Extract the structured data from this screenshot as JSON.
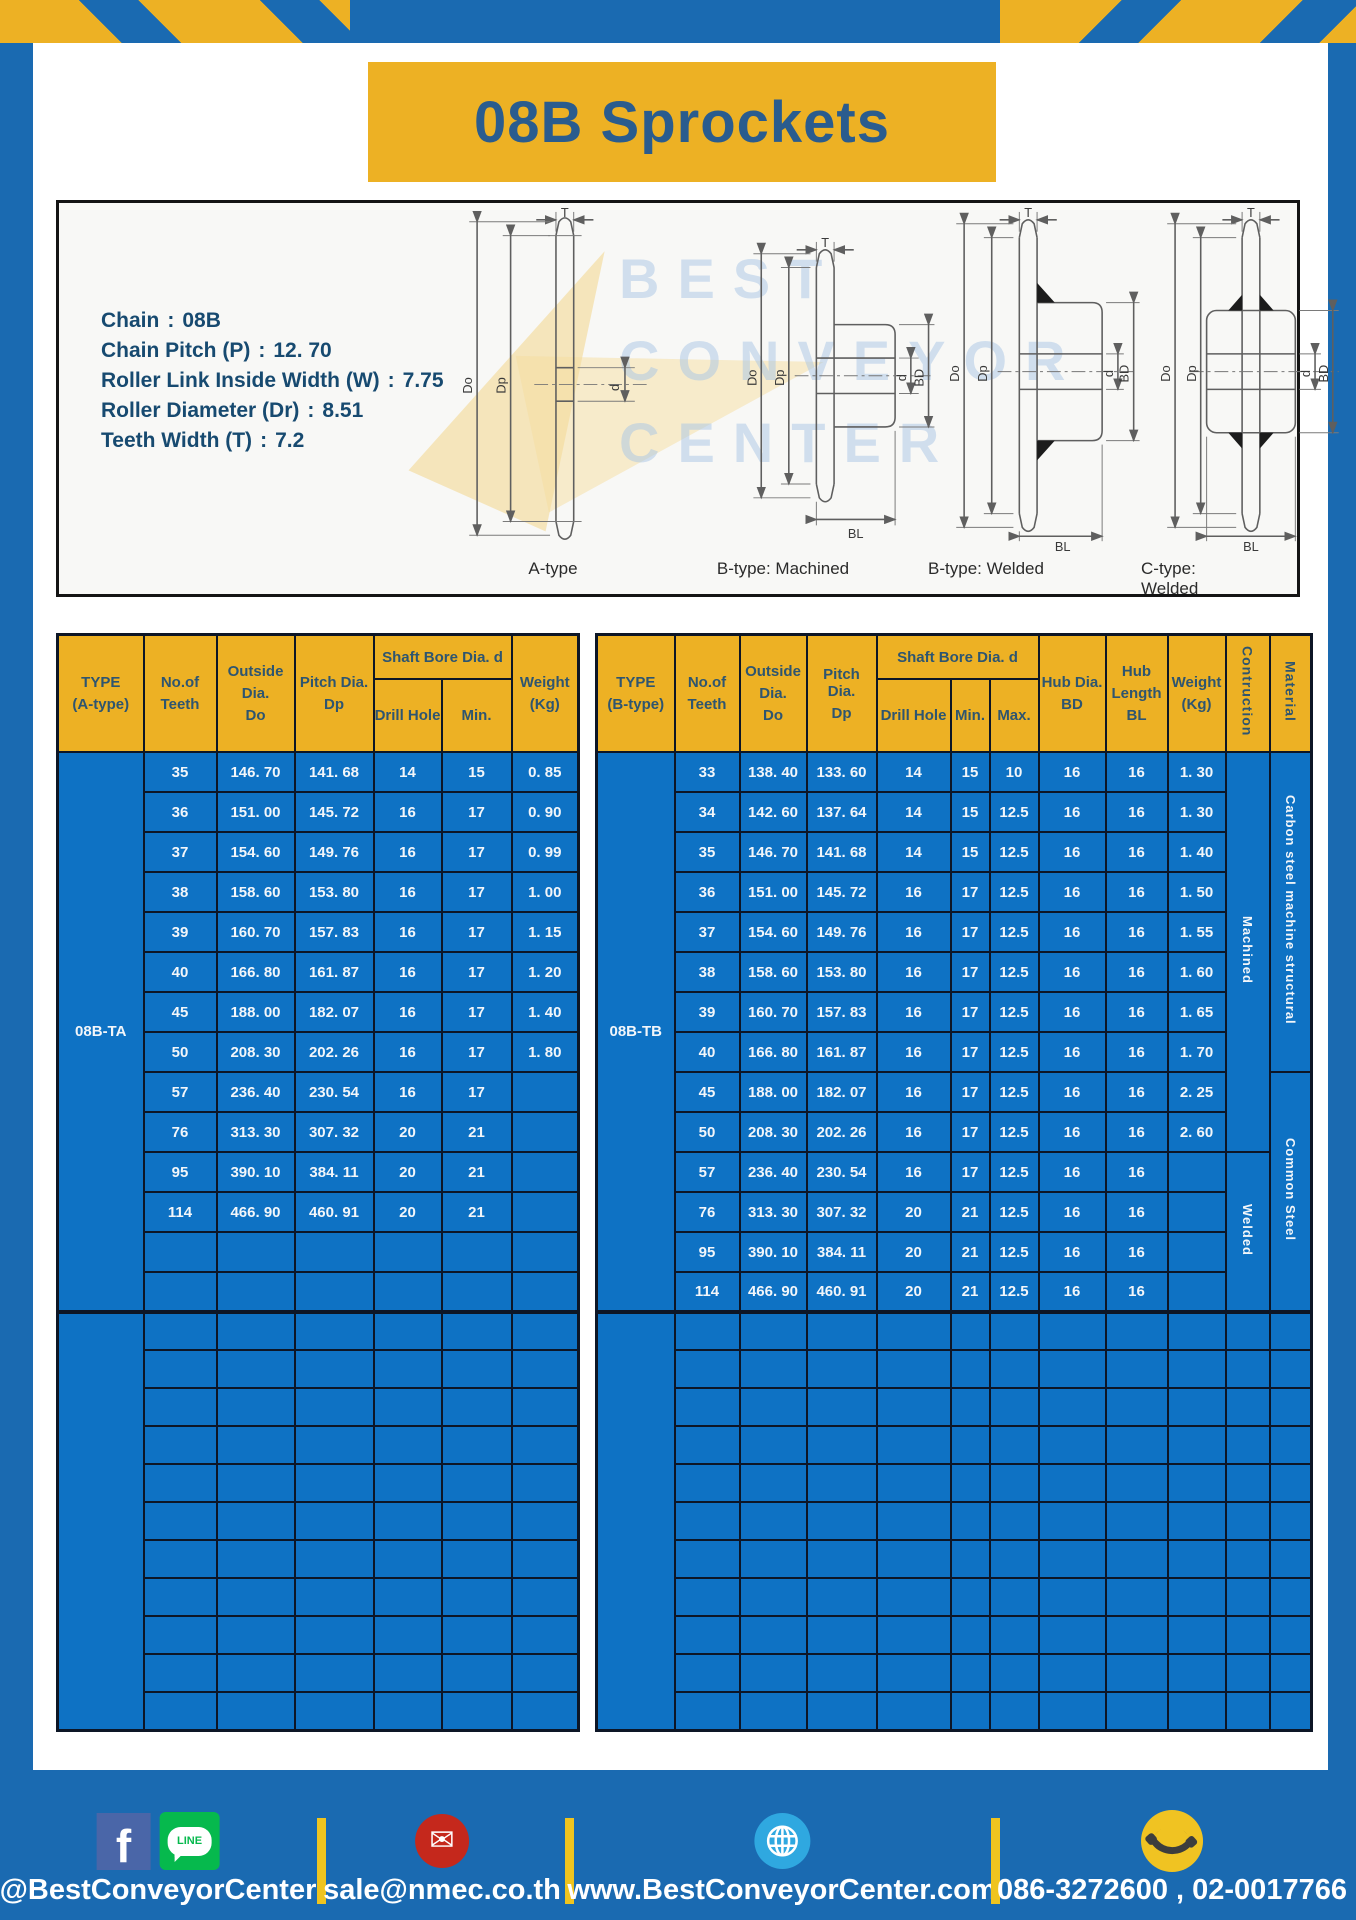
{
  "title": "08B Sprockets",
  "colors": {
    "frame_blue": "#1a6ab1",
    "table_blue": "#0e72c4",
    "header_gold": "#edb124",
    "divider_yellow": "#efc41f",
    "title_text": "#2a5c8e",
    "spec_text": "#174a70"
  },
  "specs": [
    {
      "label": "Chain",
      "value": "08B"
    },
    {
      "label": "Chain Pitch (P)",
      "value": "12. 70"
    },
    {
      "label": "Roller Link Inside Width (W)",
      "value": "7.75"
    },
    {
      "label": "Roller Diameter (Dr)",
      "value": "8.51"
    },
    {
      "label": "Teeth Width (T)",
      "value": "7.2"
    }
  ],
  "watermark": {
    "lines": [
      "BEST",
      "CONVEYOR",
      "CENTER"
    ]
  },
  "diagram": {
    "dims": {
      "T": "T",
      "Do": "Do",
      "Dp": "Dp",
      "d": "d",
      "BD": "BD",
      "BL": "BL"
    },
    "types": [
      "A-type",
      "B-type: Machined",
      "B-type: Welded",
      "C-type: Welded"
    ]
  },
  "left_table": {
    "header": {
      "type": [
        "TYPE",
        "(A-type)"
      ],
      "teeth": [
        "No.of",
        "Teeth"
      ],
      "outside": [
        "Outside",
        "Dia.",
        "Do"
      ],
      "pitch": [
        "Pitch Dia.",
        "Dp"
      ],
      "shaft_bore": "Shaft Bore Dia. d",
      "drill": "Drill Hole",
      "min": "Min.",
      "weight": [
        "Weight",
        "(Kg)"
      ]
    },
    "type_label": "08B-TA",
    "rows": [
      [
        "35",
        "146. 70",
        "141. 68",
        "14",
        "15",
        "0. 85"
      ],
      [
        "36",
        "151. 00",
        "145. 72",
        "16",
        "17",
        "0. 90"
      ],
      [
        "37",
        "154. 60",
        "149. 76",
        "16",
        "17",
        "0. 99"
      ],
      [
        "38",
        "158. 60",
        "153. 80",
        "16",
        "17",
        "1. 00"
      ],
      [
        "39",
        "160. 70",
        "157. 83",
        "16",
        "17",
        "1. 15"
      ],
      [
        "40",
        "166. 80",
        "161. 87",
        "16",
        "17",
        "1. 20"
      ],
      [
        "45",
        "188. 00",
        "182. 07",
        "16",
        "17",
        "1. 40"
      ],
      [
        "50",
        "208. 30",
        "202. 26",
        "16",
        "17",
        "1. 80"
      ],
      [
        "57",
        "236. 40",
        "230. 54",
        "16",
        "17",
        ""
      ],
      [
        "76",
        "313. 30",
        "307. 32",
        "20",
        "21",
        ""
      ],
      [
        "95",
        "390. 10",
        "384. 11",
        "20",
        "21",
        ""
      ],
      [
        "114",
        "466. 90",
        "460. 91",
        "20",
        "21",
        ""
      ]
    ],
    "block1_empty_rows": 2,
    "block2_empty_rows": 11,
    "block2_cols": 6
  },
  "right_table": {
    "header": {
      "type": [
        "TYPE",
        "(B-type)"
      ],
      "teeth": [
        "No.of",
        "Teeth"
      ],
      "outside": [
        "Outside",
        "Dia.",
        "Do"
      ],
      "pitch": [
        "Pitch Dia.",
        "Dp"
      ],
      "shaft_bore": "Shaft Bore Dia. d",
      "drill": "Drill Hole",
      "min": "Min.",
      "max": "Max.",
      "hub_dia": [
        "Hub Dia.",
        "BD"
      ],
      "hub_len": [
        "Hub",
        "Length",
        "BL"
      ],
      "weight": [
        "Weight",
        "(Kg)"
      ],
      "construction": "Contruction",
      "material": "Material"
    },
    "type_label": "08B-TB",
    "rows": [
      [
        "33",
        "138. 40",
        "133. 60",
        "14",
        "15",
        "10",
        "16",
        "16",
        "1. 30"
      ],
      [
        "34",
        "142. 60",
        "137. 64",
        "14",
        "15",
        "12.5",
        "16",
        "16",
        "1. 30"
      ],
      [
        "35",
        "146. 70",
        "141. 68",
        "14",
        "15",
        "12.5",
        "16",
        "16",
        "1. 40"
      ],
      [
        "36",
        "151. 00",
        "145. 72",
        "16",
        "17",
        "12.5",
        "16",
        "16",
        "1. 50"
      ],
      [
        "37",
        "154. 60",
        "149. 76",
        "16",
        "17",
        "12.5",
        "16",
        "16",
        "1. 55"
      ],
      [
        "38",
        "158. 60",
        "153. 80",
        "16",
        "17",
        "12.5",
        "16",
        "16",
        "1. 60"
      ],
      [
        "39",
        "160. 70",
        "157. 83",
        "16",
        "17",
        "12.5",
        "16",
        "16",
        "1. 65"
      ],
      [
        "40",
        "166. 80",
        "161. 87",
        "16",
        "17",
        "12.5",
        "16",
        "16",
        "1. 70"
      ],
      [
        "45",
        "188. 00",
        "182. 07",
        "16",
        "17",
        "12.5",
        "16",
        "16",
        "2. 25"
      ],
      [
        "50",
        "208. 30",
        "202. 26",
        "16",
        "17",
        "12.5",
        "16",
        "16",
        "2. 60"
      ],
      [
        "57",
        "236. 40",
        "230. 54",
        "16",
        "17",
        "12.5",
        "16",
        "16",
        ""
      ],
      [
        "76",
        "313. 30",
        "307. 32",
        "20",
        "21",
        "12.5",
        "16",
        "16",
        ""
      ],
      [
        "95",
        "390. 10",
        "384. 11",
        "20",
        "21",
        "12.5",
        "16",
        "16",
        ""
      ],
      [
        "114",
        "466. 90",
        "460. 91",
        "20",
        "21",
        "12.5",
        "16",
        "16",
        ""
      ]
    ],
    "spans": [
      {
        "start": 0,
        "rows": 10,
        "label": "Machined",
        "name": "construction-cell"
      },
      {
        "start": 0,
        "rows": 8,
        "label": "Carbon steel  machine structural",
        "name": "material-cell"
      },
      {
        "start": 8,
        "rows": 6,
        "label": "Common Steel",
        "name": "material-cell"
      },
      {
        "start": 10,
        "rows": 4,
        "label": "Welded",
        "name": "construction-cell"
      }
    ],
    "block1_empty_rows": 0,
    "block2_empty_rows": 11,
    "block2_cols": 11
  },
  "footer": {
    "social_handle": "@BestConveyorCenter",
    "line_label": "LINE",
    "email": "sale@nmec.co.th",
    "website": "www.BestConveyorCenter.com",
    "phone": "086-3272600 , 02-0017766"
  }
}
